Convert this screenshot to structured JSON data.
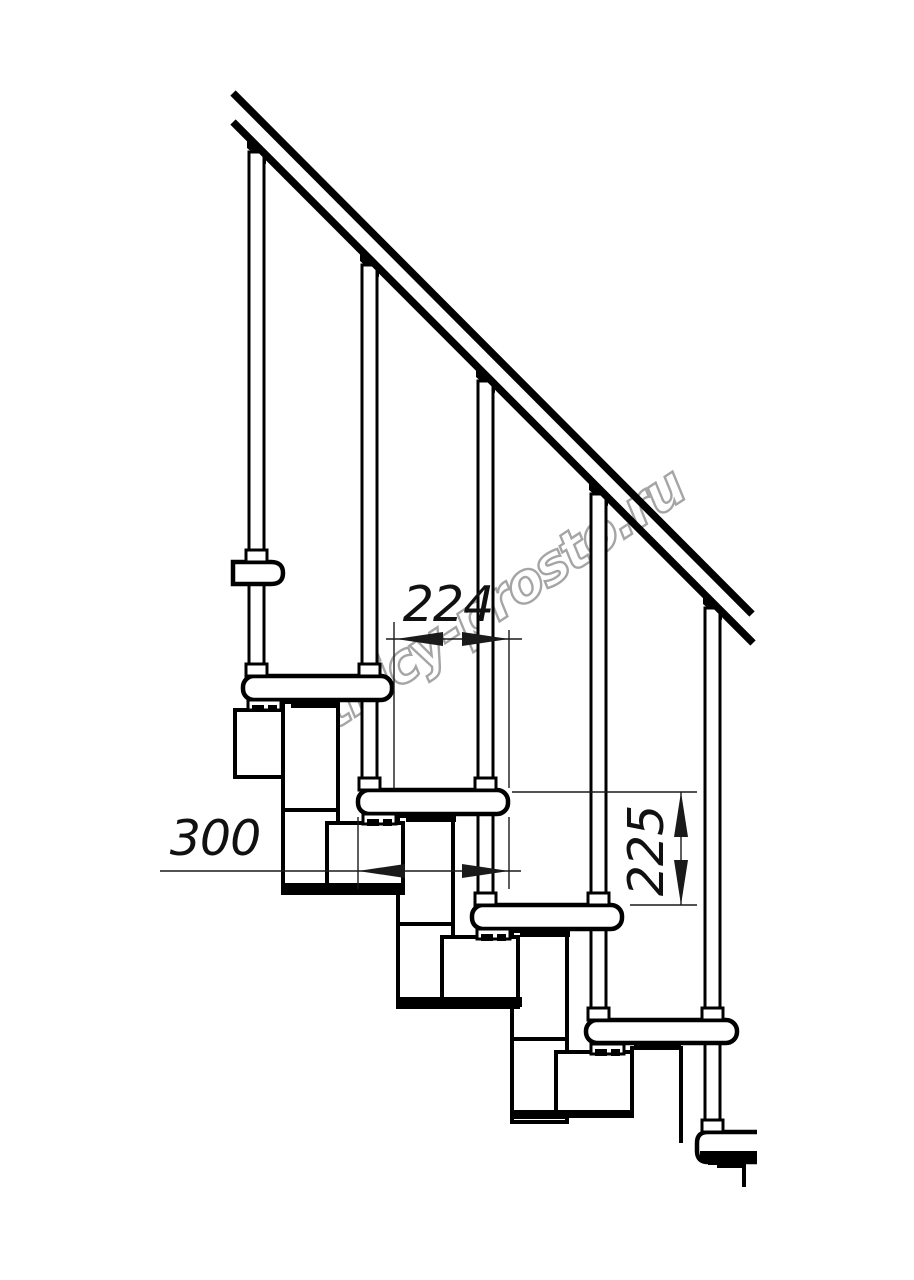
{
  "drawing": {
    "watermark": "lestnicy-prosto.ru",
    "dimensions": {
      "going": "224",
      "tread_depth": "300",
      "rise": "225"
    },
    "colors": {
      "line": "#000000",
      "dimension": "#1a1a1a",
      "watermark_outline": "#9c9c9c",
      "background": "#ffffff"
    }
  }
}
